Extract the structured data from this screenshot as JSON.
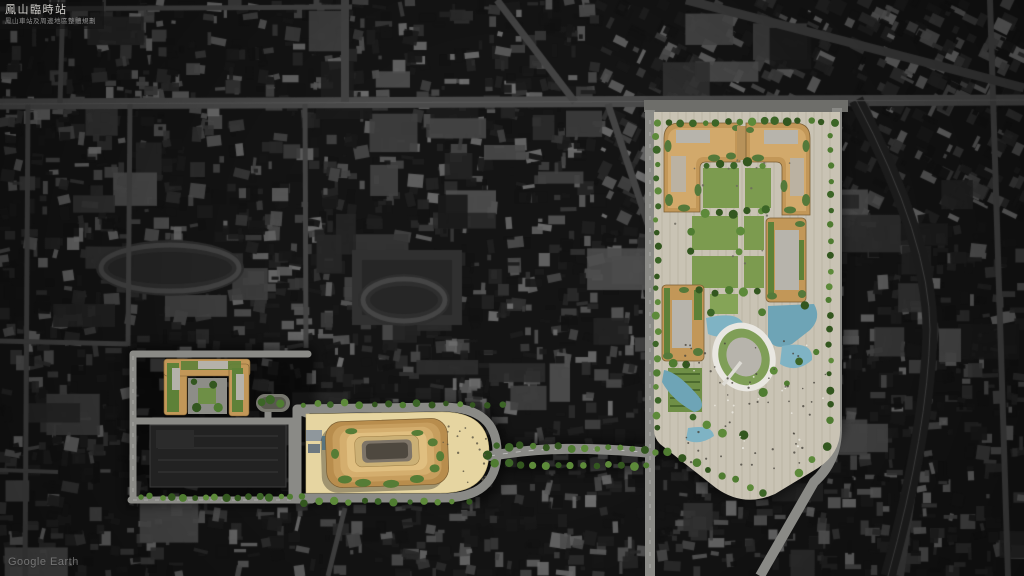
{
  "header": {
    "title": "鳳山臨時站",
    "subtitle": "鳳山車站及周邊地區整體規劃"
  },
  "footer": {
    "watermark": "Google Earth"
  },
  "map": {
    "view": "satellite-aerial-masterplan",
    "theme": "dark-desaturated-context-with-color-render-overlay",
    "features": [
      "transit-park-block",
      "park-lawn-grid",
      "terraced-courtyard-buildings",
      "oval-sunken-plaza",
      "water-gardens",
      "station-terraced-building",
      "station-sand-plaza",
      "landscaped-boulevard",
      "west-mixed-use-block",
      "existing-dark-roof-structure",
      "street-tree-rows",
      "satellite-city-context"
    ],
    "palette": {
      "context_base": "#161616",
      "context_road": "#464646",
      "design_road": "#8a8a86",
      "plaza_paving": "#c9c3b4",
      "station_plaza_sand": "#e6d5a1",
      "proposed_building_gold": "#c29758",
      "terrace_light_gold": "#e0bf80",
      "green_lawn": "#7c9b4f",
      "tree_green": "#3c6527",
      "roof_garden_green": "#5e8138",
      "water_blue": "#7fb3c4",
      "oval_rim_white": "#e9e7e1"
    }
  }
}
